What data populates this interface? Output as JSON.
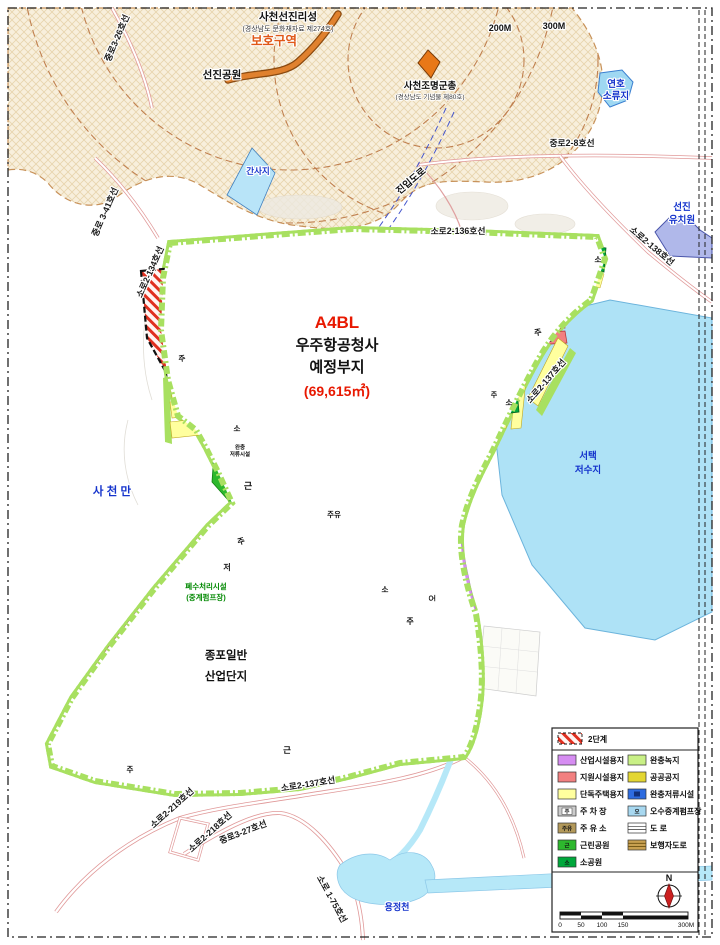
{
  "site": {
    "code": "A4BL",
    "name_line1": "우주항공청사",
    "name_line2": "예정부지",
    "area": "(69,615㎡)"
  },
  "annotations": {
    "castle": "사천선진리성",
    "castle_sub": "(경상남도 문화재자료 제274호)",
    "protection_zone": "보호구역",
    "park": "선진공원",
    "tomb": "사천조명군총",
    "tomb_sub": "(경상남도 기념물 제80호)",
    "radius_200": "200M",
    "radius_300": "300M",
    "pond_line1": "연호",
    "pond_line2": "소류지",
    "tidal_flat": "간사지",
    "access_road": "진입도로",
    "kindergarten_line1": "선진",
    "kindergarten_line2": "유치원",
    "bay": "사 천 만",
    "reservoir_line1": "서택",
    "reservoir_line2": "저수지",
    "complex_line1": "종포일반",
    "complex_line2": "산업단지",
    "waste_line1": "폐수처리시설",
    "waste_line2": "(중계펌프장)",
    "stream": "용정천"
  },
  "roads": {
    "jungro3_26": "중로3-26호선",
    "jungro3_41": "중로 3-41호선",
    "soro2_134": "소로2-134호선",
    "soro2_136": "소로2-136호선",
    "jungro2_8": "중로2-8호선",
    "soro2_138": "소로2-138호선",
    "soro2_137_right": "소로2-137호선",
    "soro2_137_bottom": "소로2-137호선",
    "soro2_219": "소로2-219호선",
    "soro2_218": "소로2-218호선",
    "jungro3_27": "중로3-27호선",
    "soro1_75": "소로 1-75호선"
  },
  "markers": {
    "parking": "주",
    "gas": "주유",
    "small_park": "소",
    "neighborhood_park": "근",
    "detention_line1": "완충",
    "detention_line2": "저류시설",
    "retention": "저",
    "sewage_pump": "오"
  },
  "legend": {
    "phase2": "2단계",
    "left": [
      {
        "label": "산업시설용지",
        "color": "#d68df2"
      },
      {
        "label": "지원시설용지",
        "color": "#f28080"
      },
      {
        "label": "단독주택용지",
        "color": "#ffff9e"
      },
      {
        "label": "주 차 장",
        "color": "#cccccc",
        "letter": "주"
      },
      {
        "label": "주 유 소",
        "color": "#b3995a",
        "letter": "주유"
      },
      {
        "label": "근린공원",
        "color": "#2db82d",
        "letter": "근"
      },
      {
        "label": "소공원",
        "color": "#00a83c",
        "letter": "소"
      }
    ],
    "right": [
      {
        "label": "완충녹지",
        "color": "#c9f086"
      },
      {
        "label": "공공공지",
        "color": "#e3d632"
      },
      {
        "label": "완충저류시설",
        "color": "#2e6ce0"
      },
      {
        "label": "오수중계펌프장",
        "color": "#a8d8f0",
        "letter": "오"
      },
      {
        "label": "도  로",
        "color": "#ffffff"
      },
      {
        "label": "보행자도로",
        "color": "#c8a050"
      }
    ]
  },
  "compass": {
    "north": "N"
  },
  "scalebar": {
    "t0": "0",
    "t1": "50",
    "t2": "100",
    "t3": "150",
    "t4": "300M"
  },
  "colors": {
    "industrial": "#d68df2",
    "support": "#f28080",
    "housing": "#ffff9e",
    "buffer_green": "#a8e060",
    "park_green": "#2db82d",
    "water": "#aee2f6",
    "boundary_red": "#cc2200",
    "a4bl_fill": "#f6d94e",
    "a4bl_border": "#e81800",
    "phase2_hatch": "#e03020",
    "protection_text": "#e05818"
  }
}
